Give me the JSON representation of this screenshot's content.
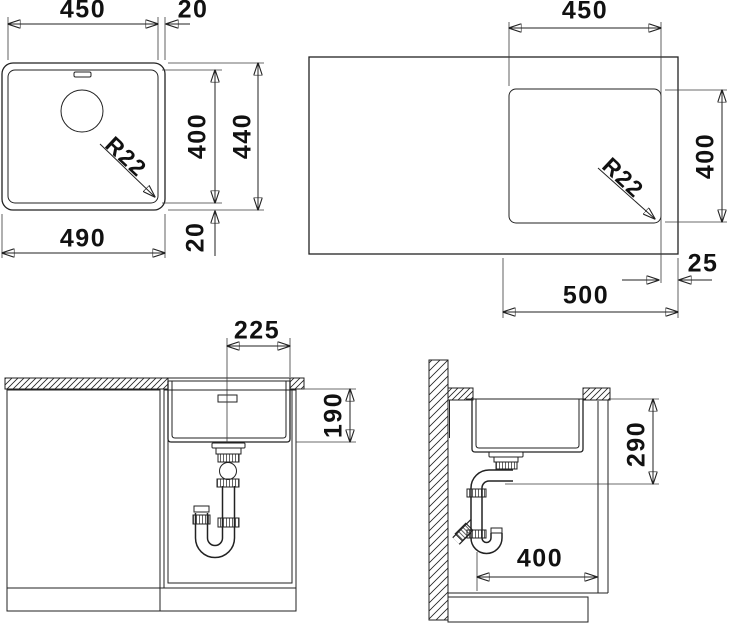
{
  "drawing": {
    "title": "sink-installation-drawing",
    "top_view": {
      "bowl_width": "450",
      "rim_right": "20",
      "bowl_height": "400",
      "outer_height": "440",
      "outer_width": "490",
      "rim_bottom": "20",
      "corner_radius": "R22"
    },
    "cutout_view": {
      "cutout_width": "450",
      "cutout_height": "400",
      "corner_radius": "R22",
      "edge_margin": "25",
      "span": "500"
    },
    "front_view": {
      "drain_offset": "225",
      "bowl_depth": "190"
    },
    "side_view": {
      "outlet_depth": "290",
      "trap_distance": "400"
    },
    "colors": {
      "line": "#222222",
      "text": "#111111",
      "background": "#ffffff"
    }
  }
}
